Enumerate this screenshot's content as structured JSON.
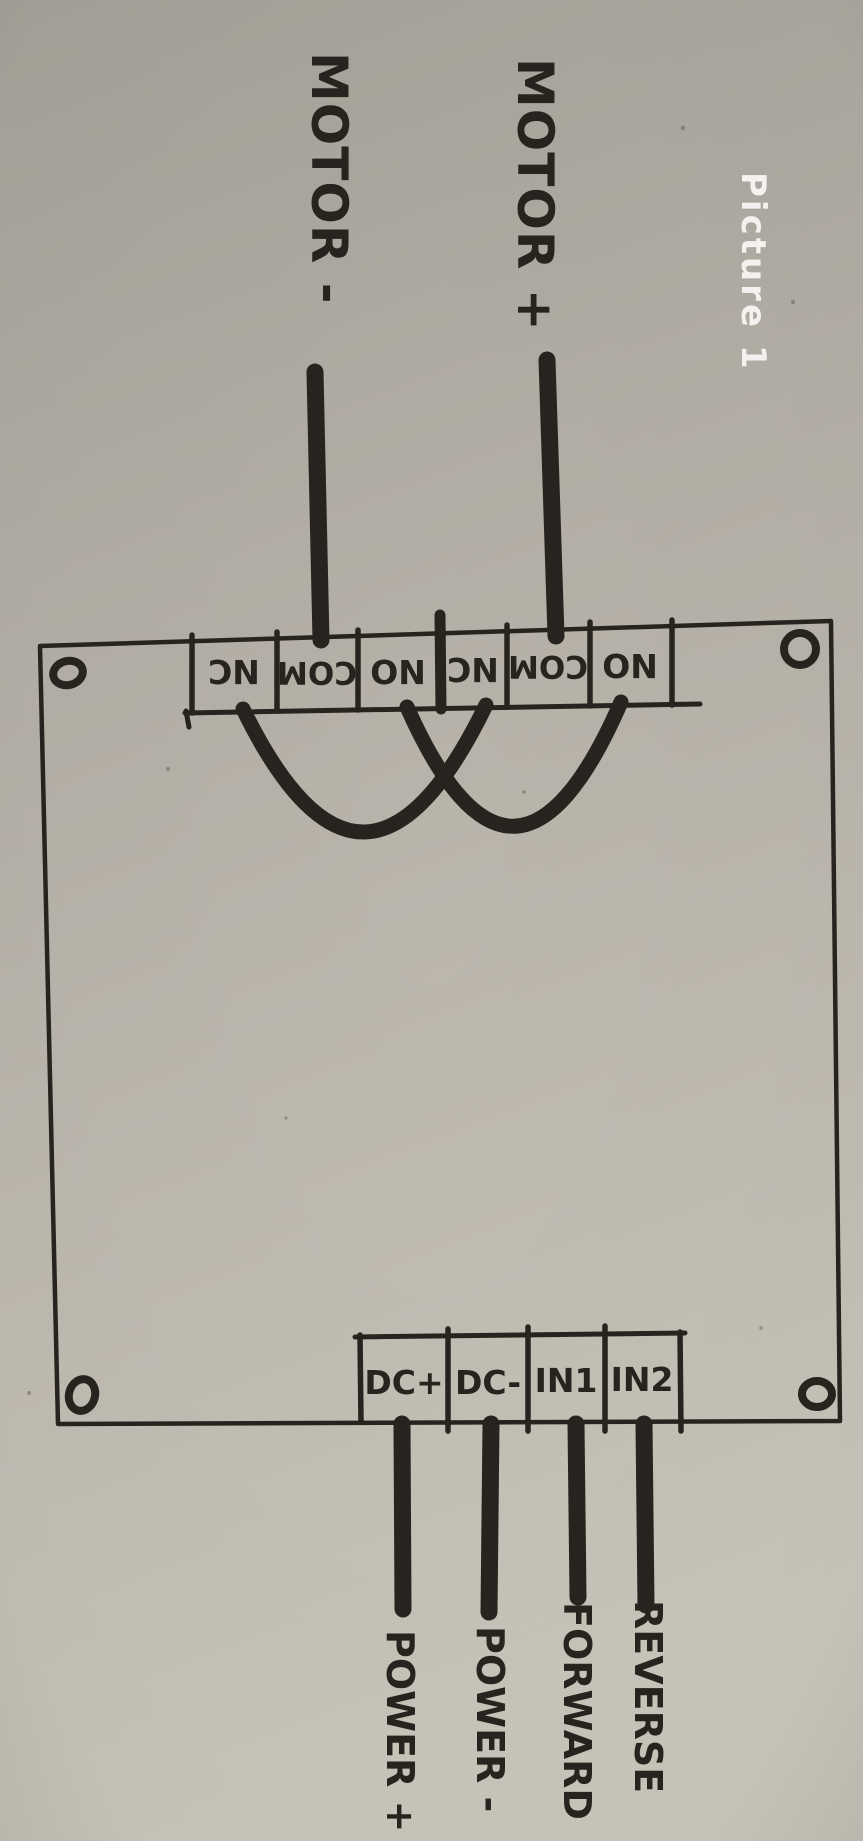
{
  "caption": {
    "text": "Picture 1",
    "color": "#f3f2ee"
  },
  "sketch": {
    "ink_color": "#27231e",
    "paper_color": "#b6b1a8",
    "motor_minus_label": "MOTOR -",
    "motor_plus_label": "MOTOR +",
    "relay_terminals": [
      "NC",
      "COM",
      "NO",
      "NC",
      "COM",
      "NO"
    ],
    "input_terminals": [
      "DC+",
      "DC-",
      "IN1",
      "IN2"
    ],
    "wire_labels": [
      "POWER +",
      "POWER -",
      "FORWARD",
      "REVERSE"
    ]
  }
}
